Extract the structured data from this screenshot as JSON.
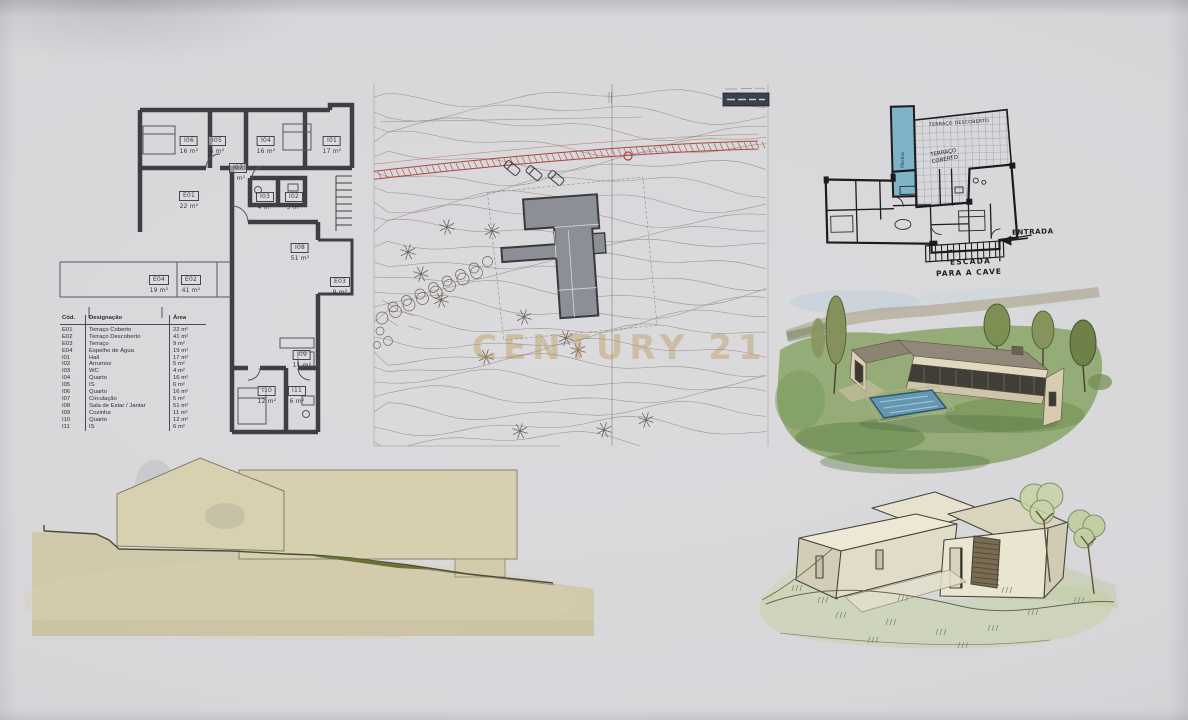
{
  "watermark": {
    "text": "CENTURY 21"
  },
  "legend": {
    "headers": {
      "code": "Cód.",
      "name": "Designação",
      "area": "Área"
    },
    "rows": [
      {
        "code": "E01",
        "name": "Terraço Coberto",
        "area": "22 m²"
      },
      {
        "code": "E02",
        "name": "Terraço Descoberto",
        "area": "41 m²"
      },
      {
        "code": "E03",
        "name": "Terraço",
        "area": "9 m²"
      },
      {
        "code": "E04",
        "name": "Espelho de Água",
        "area": "19 m²"
      },
      {
        "code": "I01",
        "name": "Hall",
        "area": "17 m²"
      },
      {
        "code": "I02",
        "name": "Arrumos",
        "area": "5 m²"
      },
      {
        "code": "I03",
        "name": "WC",
        "area": "4 m²"
      },
      {
        "code": "I04",
        "name": "Quarto",
        "area": "16 m²"
      },
      {
        "code": "I05",
        "name": "IS",
        "area": "6 m²"
      },
      {
        "code": "I06",
        "name": "Quarto",
        "area": "16 m²"
      },
      {
        "code": "I07",
        "name": "Circulação",
        "area": "5 m²"
      },
      {
        "code": "I08",
        "name": "Sala de Estar / Jantar",
        "area": "51 m²"
      },
      {
        "code": "I09",
        "name": "Cozinha",
        "area": "11 m²"
      },
      {
        "code": "I10",
        "name": "Quarto",
        "area": "12 m²"
      },
      {
        "code": "I11",
        "name": "IS",
        "area": "6 m²"
      }
    ]
  },
  "floor_plan": {
    "rooms": [
      {
        "code": "I06",
        "area": "16 m²"
      },
      {
        "code": "I05",
        "area": "6 m²"
      },
      {
        "code": "I04",
        "area": "16 m²"
      },
      {
        "code": "I01",
        "area": "17 m²"
      },
      {
        "code": "I07",
        "area": "5 m²"
      },
      {
        "code": "E01",
        "area": "22 m²"
      },
      {
        "code": "I03",
        "area": "4 m²"
      },
      {
        "code": "I02",
        "area": "5 m²"
      },
      {
        "code": "I08",
        "area": "51 m²"
      },
      {
        "code": "E04",
        "area": "19 m²"
      },
      {
        "code": "E02",
        "area": "41 m²"
      },
      {
        "code": "E03",
        "area": "9 m²"
      },
      {
        "code": "I09",
        "area": "11 m²"
      },
      {
        "code": "I10",
        "area": "12 m²"
      },
      {
        "code": "I11",
        "area": "6 m²"
      }
    ]
  },
  "sketch_plan": {
    "pool_label": "Piscina",
    "terrace_open_label": "TERRAÇO DESCOBERTO",
    "terrace_covered_line1": "TERRAÇO",
    "terrace_covered_line2": "COBERTO",
    "entrance_label": "ENTRADA",
    "stairs_line1": "ESCADA",
    "stairs_line2": "PARA A CAVE"
  },
  "colors": {
    "paper": "#d6d5d8",
    "plan_ink": "#3f3f43",
    "site_ink": "#98928a",
    "road_red": "#a9473d",
    "pool_blue": "#7fb3c8",
    "lawn_green": "#83a15f",
    "wash_beige": "#d3cca9",
    "watermark_gold": "#bb9855",
    "sketch_ink": "#1c1c1e"
  }
}
